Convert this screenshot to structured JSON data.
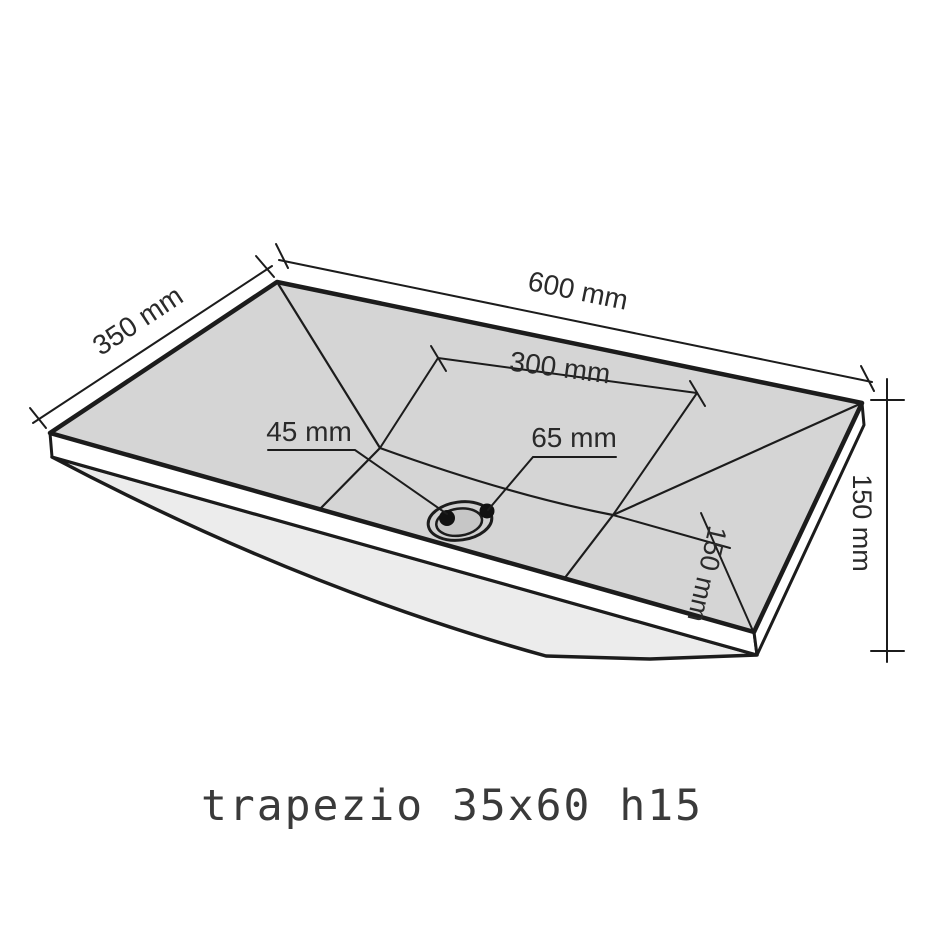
{
  "diagram": {
    "caption": "trapezio 35x60 h15",
    "dimensions": {
      "width_600": "600 mm",
      "depth_350": "350 mm",
      "drain_center_300": "300 mm",
      "drain_45": "45 mm",
      "drain_65": "65 mm",
      "drain_inset_150": "150 mm",
      "height_150": "150 mm"
    },
    "colors": {
      "surface": "#d5d5d5",
      "underside": "#ececec",
      "rim": "#ffffff",
      "drain_ring": "#d0d0d0",
      "drain_inner": "#c6c6c6",
      "line": "#1c1c1c",
      "background": "#ffffff"
    }
  }
}
